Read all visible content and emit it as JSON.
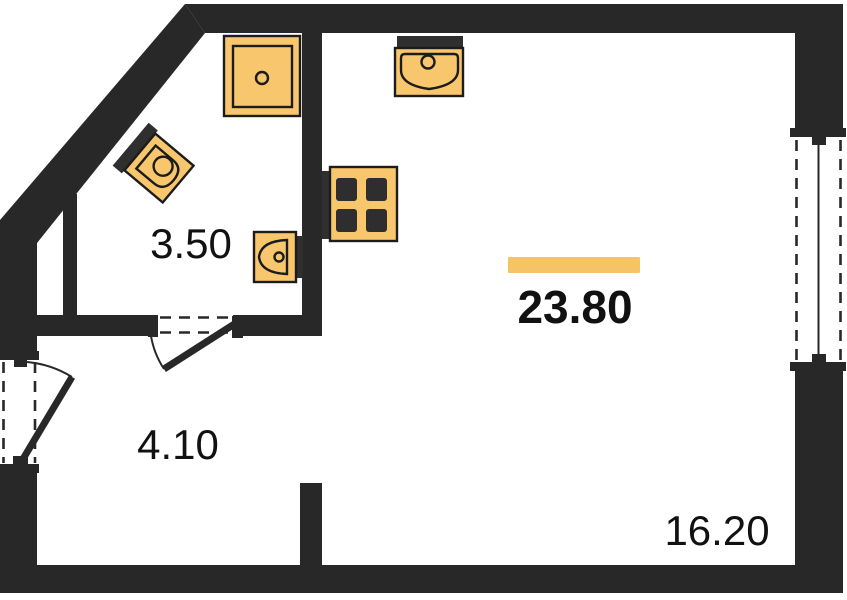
{
  "plan": {
    "type": "apartment-floor-plan",
    "rooms": {
      "bathroom": {
        "area": "3.50"
      },
      "hall": {
        "area": "4.10"
      },
      "total": {
        "area": "23.80",
        "highlighted": true
      },
      "living": {
        "area": "16.20"
      }
    },
    "fixtures": [
      "shower-tray",
      "corner-sink",
      "toilet",
      "stove-4-burners",
      "kitchen-sink"
    ],
    "openings": [
      "interior-door-swing",
      "left-window-swing",
      "right-window-fixed"
    ],
    "colors": {
      "wall": "#282828",
      "fixture": "#F8C76D",
      "accent": "#F6C365",
      "line": "#1c1c1c",
      "bg": "#ffffff"
    }
  }
}
